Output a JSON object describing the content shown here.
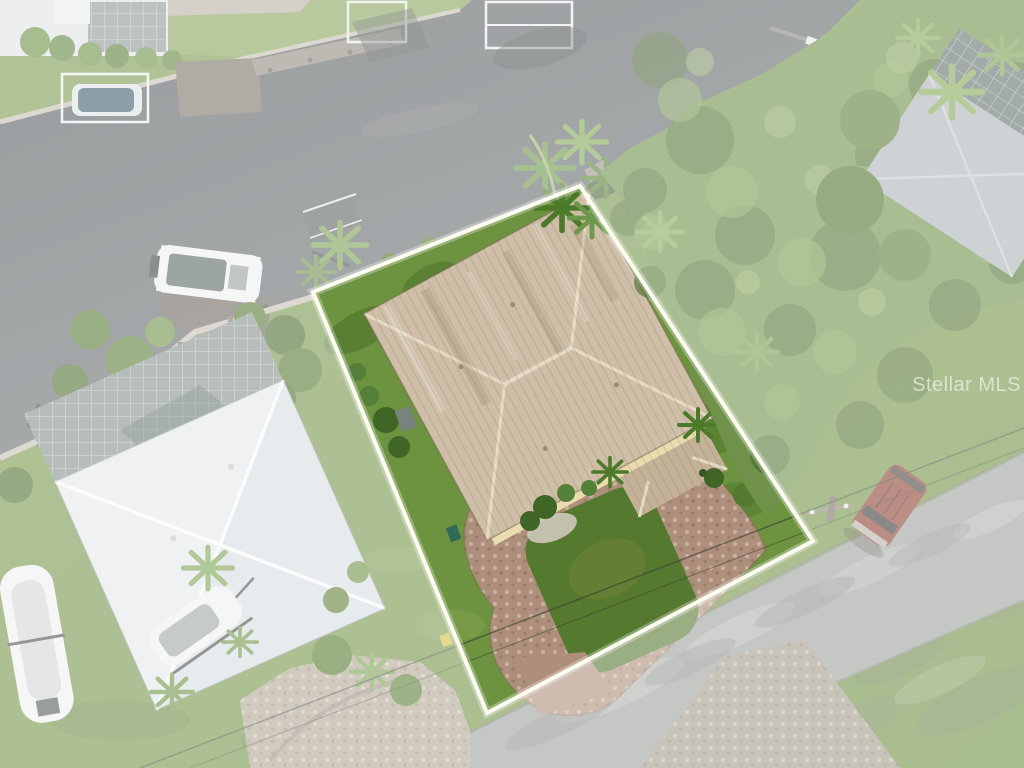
{
  "watermark": {
    "text": "Stellar MLS",
    "color": "rgba(255,255,255,0.58)"
  },
  "colors": {
    "water_dark": "#565c5f",
    "water_light": "#74797a",
    "grass_a": "#7e9c52",
    "grass_b": "#6f9144",
    "tree_base": "#6f914a",
    "road": "#9fa29e",
    "apron": "#a59d8d",
    "lot_grass": "#6d9240",
    "lot_grass_dark": "#55792f",
    "pavers": "#ad8f7b",
    "roof_tan": "#cfbfa8",
    "porch_tan": "#c4b298",
    "white_roof": "#e4e8ea",
    "white_roof_ridge": "#f8fafa",
    "cage": "#87928d",
    "car_body": "#8e4132",
    "boat_white": "#eef0ef",
    "seawall": "#c6c0b2",
    "dock_wood": "#8b8279",
    "outline": "#fdfcf0",
    "haze": "#ffffff"
  },
  "scene": {
    "description": "Aerial drone photo of a waterfront property; the listed lot is outlined in white and shown vivid while surroundings are whitened",
    "highlighted_lot": "house with tan standing-seam hip roof, horseshoe paver driveway around a lawn island, palms at the water corner",
    "canal": "dark canal water upper left with seawall, docks, boat lifts and a docked pontoon boat",
    "left_neighbor": "house with white hip roof, screened pool cage, boats on trailers, shell driveway",
    "right_neighbor": "house with gray roof and dark pool screen enclosure among dense trees",
    "street": "asphalt road at lower right with parked red-brown SUV, paver driveway apron, utility pole and power lines"
  }
}
